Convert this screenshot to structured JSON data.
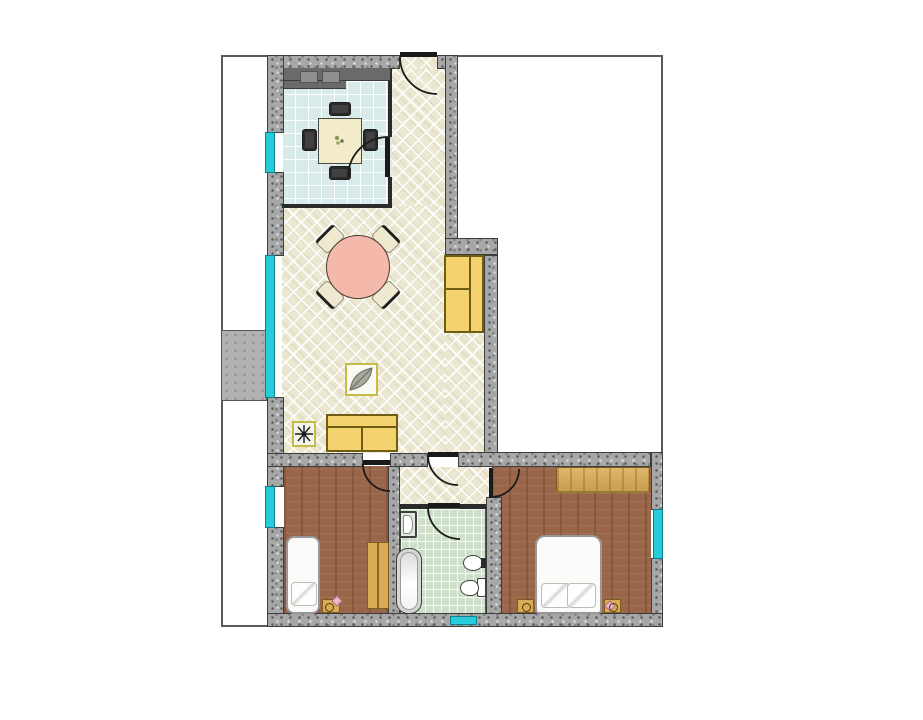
{
  "scene": {
    "kind": "apartment floor plan drawing",
    "rooms": [
      "kitchen",
      "entry-hall",
      "living-room",
      "inner-hallway",
      "bathroom",
      "bedroom-small",
      "bedroom-master",
      "balcony"
    ],
    "window_count": 5,
    "door_count": 6,
    "furniture": [
      "kitchen-counter",
      "kitchen-table-with-four-chairs",
      "round-dining-table-with-four-chairs",
      "sofa",
      "cabinet",
      "wall-decor-leaf",
      "wall-decor-star",
      "single-bed",
      "small-wardrobe",
      "nightstands",
      "bathtub",
      "washbasin",
      "bidet",
      "toilet",
      "double-bed",
      "wide-wardrobe"
    ]
  },
  "colors": {
    "page_bg": "#ffffff",
    "outline_gray": "#5a5a5a",
    "wall_base": "#a7a7a7",
    "wall_speckle_dark": "#585858",
    "wall_speckle_light": "#dcdcdc",
    "wall_border": "#3d3d3d",
    "cream_tile": "#ece7d1",
    "kitchen_tile": "#d8eaea",
    "bath_tile": "#cfe0ca",
    "bedroom_floor": "#99664a",
    "window_cyan": "#25ccd9",
    "window_frame": "#0e7f8a",
    "furniture_yellow": "#f4d26d",
    "furniture_outline": "#6f5d12",
    "counter_dark": "#6a6a6a",
    "counter_module": "#8f8f8f",
    "table_pink": "#f5b9ab",
    "chair_cream": "#efe9cf",
    "wood_light": "#d9ab55",
    "bed_white": "#fbfbf9",
    "fixture_border": "#3f3f3f",
    "dark_line": "#2b2b2b",
    "balcony_gray": "#b0b0b0",
    "accent_pink": "#e9b7c8"
  }
}
